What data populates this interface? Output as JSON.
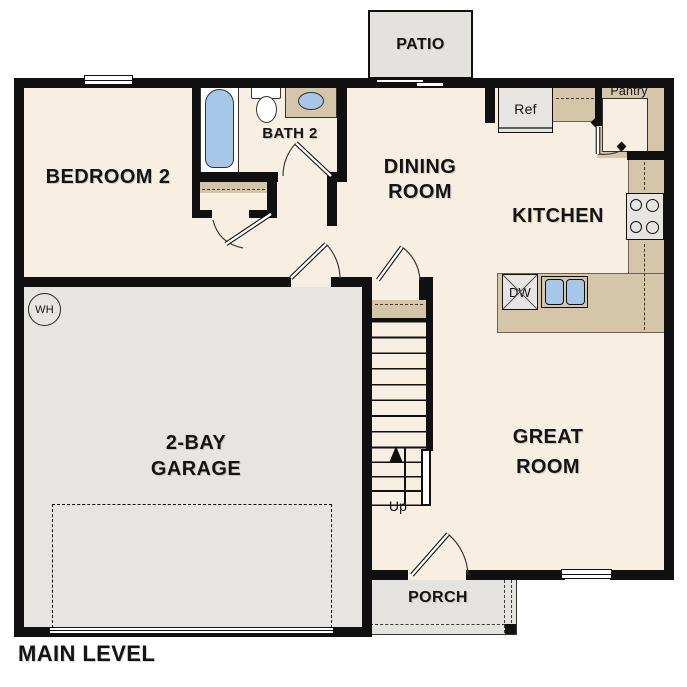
{
  "plan_title": "MAIN LEVEL",
  "rooms": {
    "bedroom2": "BEDROOM 2",
    "bath2": "BATH 2",
    "dining_line1": "DINING",
    "dining_line2": "ROOM",
    "kitchen": "KITCHEN",
    "great_room_line1": "GREAT",
    "great_room_line2": "ROOM",
    "garage_line1": "2-BAY",
    "garage_line2": "GARAGE"
  },
  "outdoor_areas": {
    "patio": "PATIO",
    "porch": "PORCH"
  },
  "labels": {
    "pantry": "Pantry",
    "refrigerator": "Ref",
    "dishwasher": "DW",
    "water_heater": "WH",
    "stair_direction": "Up"
  },
  "colors": {
    "floor": "#f7f0e2",
    "garage_floor": "#e6e5e2",
    "counter_tan": "#d5c6a9",
    "fixture_blue": "#a6c7e8",
    "wall": "#101010",
    "background": "#ffffff"
  }
}
